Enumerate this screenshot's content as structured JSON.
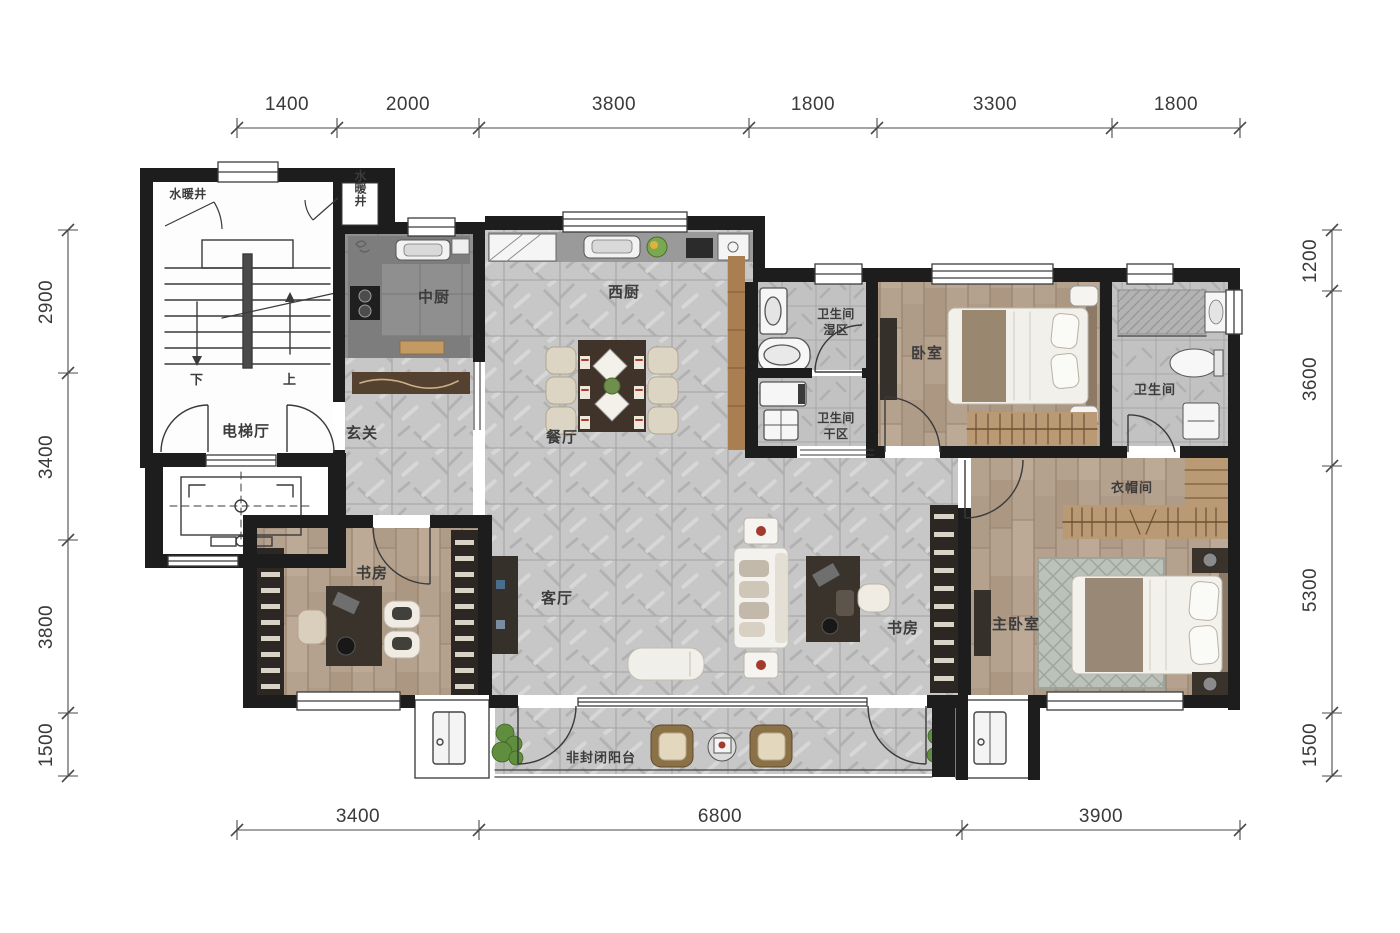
{
  "plan": {
    "rooms": {
      "shaft_left": "水暖井",
      "shaft_top": "水暖井",
      "elevator_hall": "电梯厅",
      "foyer": "玄关",
      "chinese_kitchen": "中厨",
      "west_kitchen": "西厨",
      "dining": "餐厅",
      "living": "客厅",
      "study_left": "书房",
      "study_open": "书房",
      "bath_wet_line1": "卫生间",
      "bath_wet_line2": "湿区",
      "bath_dry_line1": "卫生间",
      "bath_dry_line2": "干区",
      "bedroom": "卧室",
      "bathroom": "卫生间",
      "cloakroom": "衣帽间",
      "master_bedroom": "主卧室",
      "balcony": "非封闭阳台"
    },
    "stairs": {
      "down": "下",
      "up": "上"
    },
    "dimensions": {
      "top": [
        "1400",
        "2000",
        "3800",
        "1800",
        "3300",
        "1800"
      ],
      "bottom": [
        "3400",
        "6800",
        "3900"
      ],
      "left": [
        "2900",
        "3400",
        "3800",
        "1500"
      ],
      "right": [
        "1200",
        "3600",
        "5300",
        "1500"
      ]
    },
    "colors": {
      "wall": "#1d1d1d",
      "marble_floor": "#c7c7c7",
      "wood_floor": "#b4a18e",
      "kitchen_floor": "#8f8f8f",
      "dim_text": "#3a3a3a"
    }
  }
}
